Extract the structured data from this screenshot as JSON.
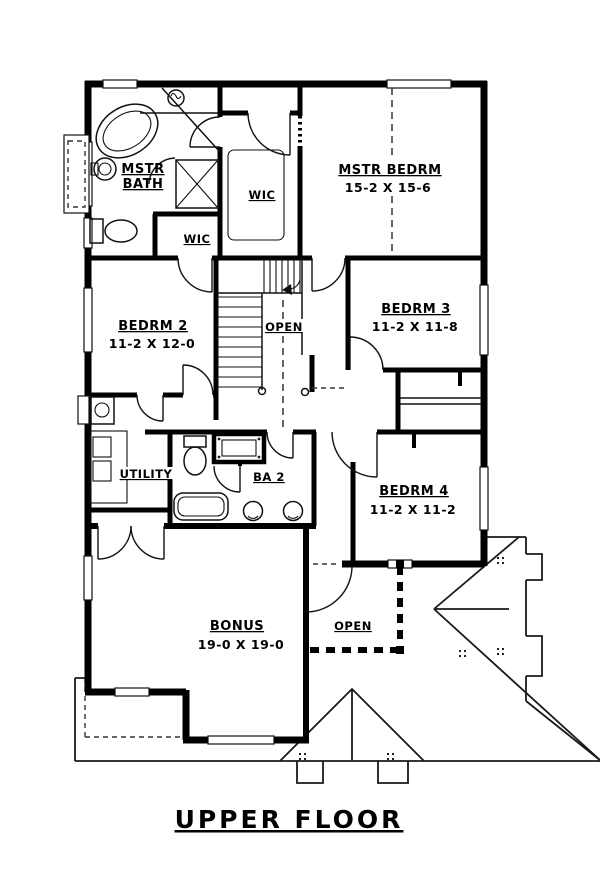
{
  "plan": {
    "title": "UPPER FLOOR",
    "rooms": [
      {
        "id": "mstr-bath",
        "line1": "MSTR",
        "line2": "BATH"
      },
      {
        "id": "wic-master",
        "name": "WIC"
      },
      {
        "id": "wic-bedrm2",
        "name": "WIC"
      },
      {
        "id": "mstr-bedrm",
        "name": "MSTR BEDRM",
        "dims": "15-2 X 15-6"
      },
      {
        "id": "bedrm-2",
        "name": "BEDRM 2",
        "dims": "11-2 X 12-0"
      },
      {
        "id": "open-stairwell",
        "name": "OPEN"
      },
      {
        "id": "bedrm-3",
        "name": "BEDRM 3",
        "dims": "11-2 X 11-8"
      },
      {
        "id": "utility",
        "name": "UTILITY"
      },
      {
        "id": "ba-2",
        "name": "BA 2"
      },
      {
        "id": "bedrm-4",
        "name": "BEDRM 4",
        "dims": "11-2 X 11-2"
      },
      {
        "id": "bonus",
        "name": "BONUS",
        "dims": "19-0 X 19-0"
      },
      {
        "id": "open-below",
        "name": "OPEN"
      }
    ],
    "colors": {
      "wall": "#000000",
      "background": "#ffffff"
    }
  }
}
